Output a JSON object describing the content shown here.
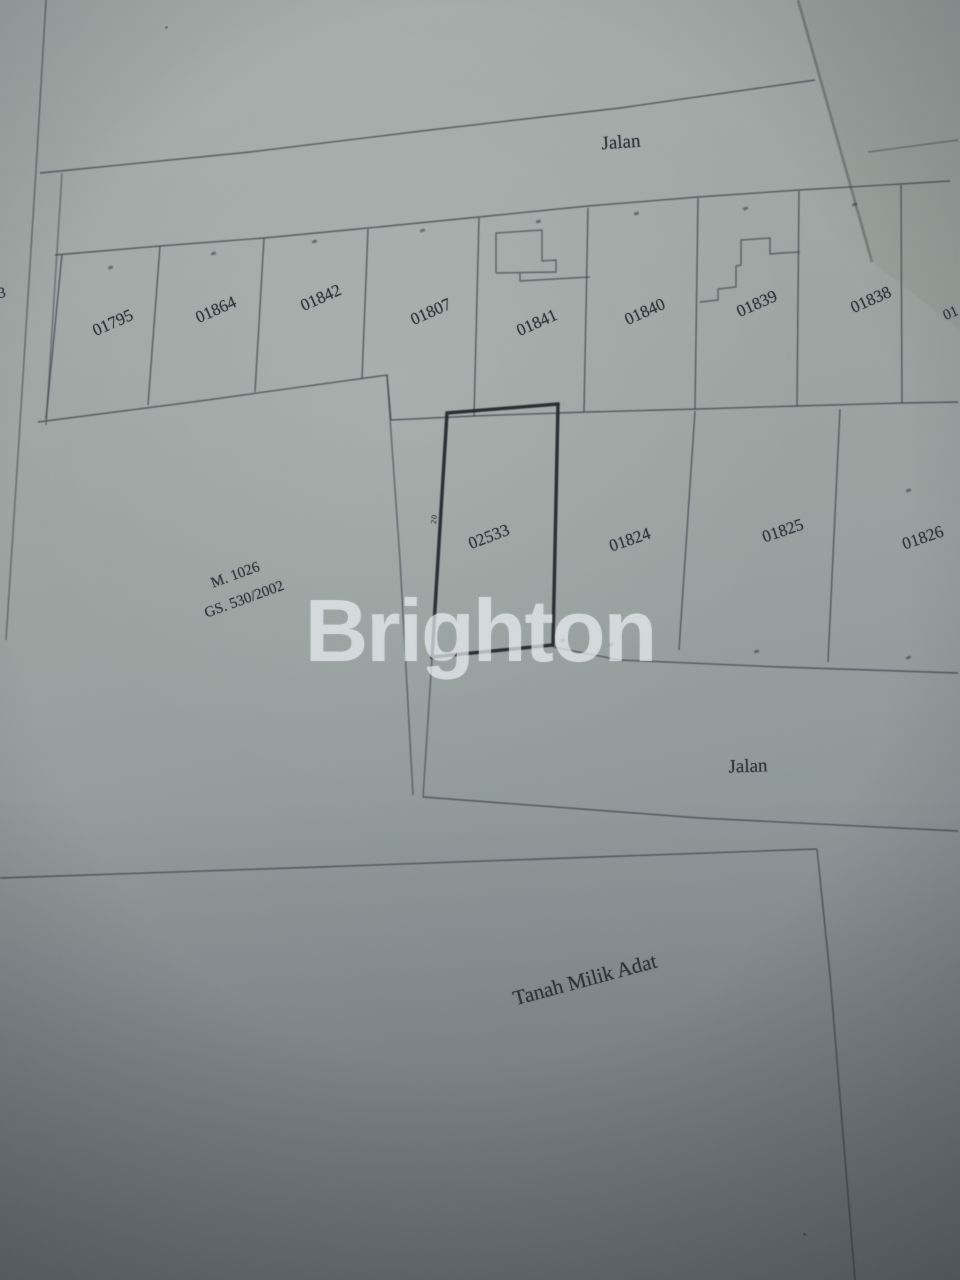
{
  "map": {
    "road_top_label": "Jalan",
    "road_bottom_label": "Jalan",
    "bottom_block_label": "Tanah Milik Adat",
    "left_block": {
      "line1": "M. 1026",
      "line2": "GS. 530/2002"
    },
    "parcels_top": [
      "01795",
      "01864",
      "01842",
      "01807",
      "01841",
      "01840",
      "01839",
      "01838"
    ],
    "parcel_partial_left": "3",
    "parcel_partial_right": "01",
    "highlighted_parcel": "02533",
    "parcels_middle": [
      "01824",
      "01825",
      "01826"
    ],
    "edge_dimension_label": "20",
    "colors": {
      "paper": "#9aa2a0",
      "ink": "#3d454d",
      "bold_ink": "#1c2127",
      "watermark": "#edf2f4"
    }
  },
  "watermark": {
    "text": "Brighton"
  }
}
